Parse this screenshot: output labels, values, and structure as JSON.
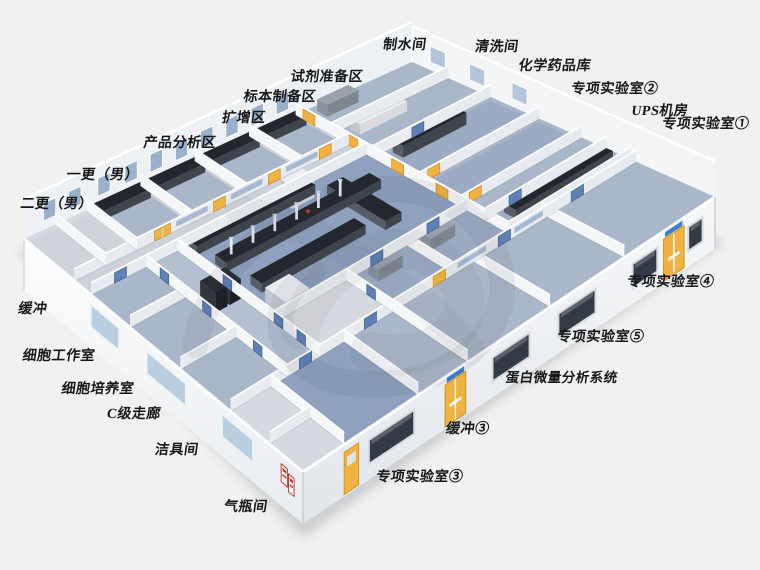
{
  "scene": {
    "description": "isometric cutaway rendering of a laboratory floor plan",
    "background": "#f1f1ef"
  },
  "palette": {
    "background": "#f1f1ef",
    "floor_base": "#c6cbd4",
    "floor_light": "#d6d9df",
    "floor_corridor": "#cdd2da",
    "floor_room_blue": "#aab6c9",
    "floor_lab_blue": "#8fa1bf",
    "floor_mid_blue": "#9babc4",
    "wall_h_face": "#e7eaee",
    "wall_v_face": "#f5f6f8",
    "wall_back_nw": "#eef1f4",
    "wall_back_ne": "#f3f5f7",
    "wall_rim": "#ffffff",
    "bench_top": "#23262c",
    "bench_front": "#3f454d",
    "bench_side": "#565d66",
    "cabinet_light_top": "#eceef1",
    "cabinet_light_front": "#d7dbe0",
    "door_yellow": "#f0b242",
    "door_yellow_edge": "#d3941f",
    "door_blue": "#5d81b5",
    "door_blue_edge": "#46699c",
    "window_interior": "#9fb4cf",
    "window_exterior_dark": "#333c46",
    "window_exterior_light": "#b9cfe0",
    "window_back": "#8ba6c6",
    "sign_blue": "#3e7fd6",
    "sign_red": "#c23b2e",
    "shadow": "rgba(125,130,140,0.30)",
    "watermark": "rgba(55,58,64,0.07)",
    "label_color": "#17181a"
  },
  "labels": [
    {
      "id": "water-production-room",
      "text": "制水间"
    },
    {
      "id": "washing-room",
      "text": "清洗间"
    },
    {
      "id": "chemical-storage",
      "text": "化学药品库"
    },
    {
      "id": "special-lab-2",
      "text": "专项实验室②"
    },
    {
      "id": "ups-room",
      "text": "UPS机房"
    },
    {
      "id": "special-lab-1",
      "text": "专项实验室①"
    },
    {
      "id": "reagent-prep-area",
      "text": "试剂准备区"
    },
    {
      "id": "specimen-prep-area",
      "text": "标本制备区"
    },
    {
      "id": "amplification-area",
      "text": "扩增区"
    },
    {
      "id": "product-analysis-area",
      "text": "产品分析区"
    },
    {
      "id": "first-change-male",
      "text": "一更（男）"
    },
    {
      "id": "second-change-male",
      "text": "二更（男）"
    },
    {
      "id": "buffer",
      "text": "缓冲"
    },
    {
      "id": "cell-workroom",
      "text": "细胞工作室"
    },
    {
      "id": "cell-culture-room",
      "text": "细胞培养室"
    },
    {
      "id": "class-c-corridor",
      "text": "C级走廊"
    },
    {
      "id": "cleaning-tools-room",
      "text": "洁具间"
    },
    {
      "id": "gas-cylinder-room",
      "text": "气瓶间"
    },
    {
      "id": "special-lab-4",
      "text": "专项实验室④"
    },
    {
      "id": "special-lab-5",
      "text": "专项实验室⑤"
    },
    {
      "id": "protein-microanalysis-system",
      "text": "蛋白微量分析系统"
    },
    {
      "id": "buffer-3",
      "text": "缓冲③"
    },
    {
      "id": "special-lab-3",
      "text": "专项实验室③"
    }
  ]
}
